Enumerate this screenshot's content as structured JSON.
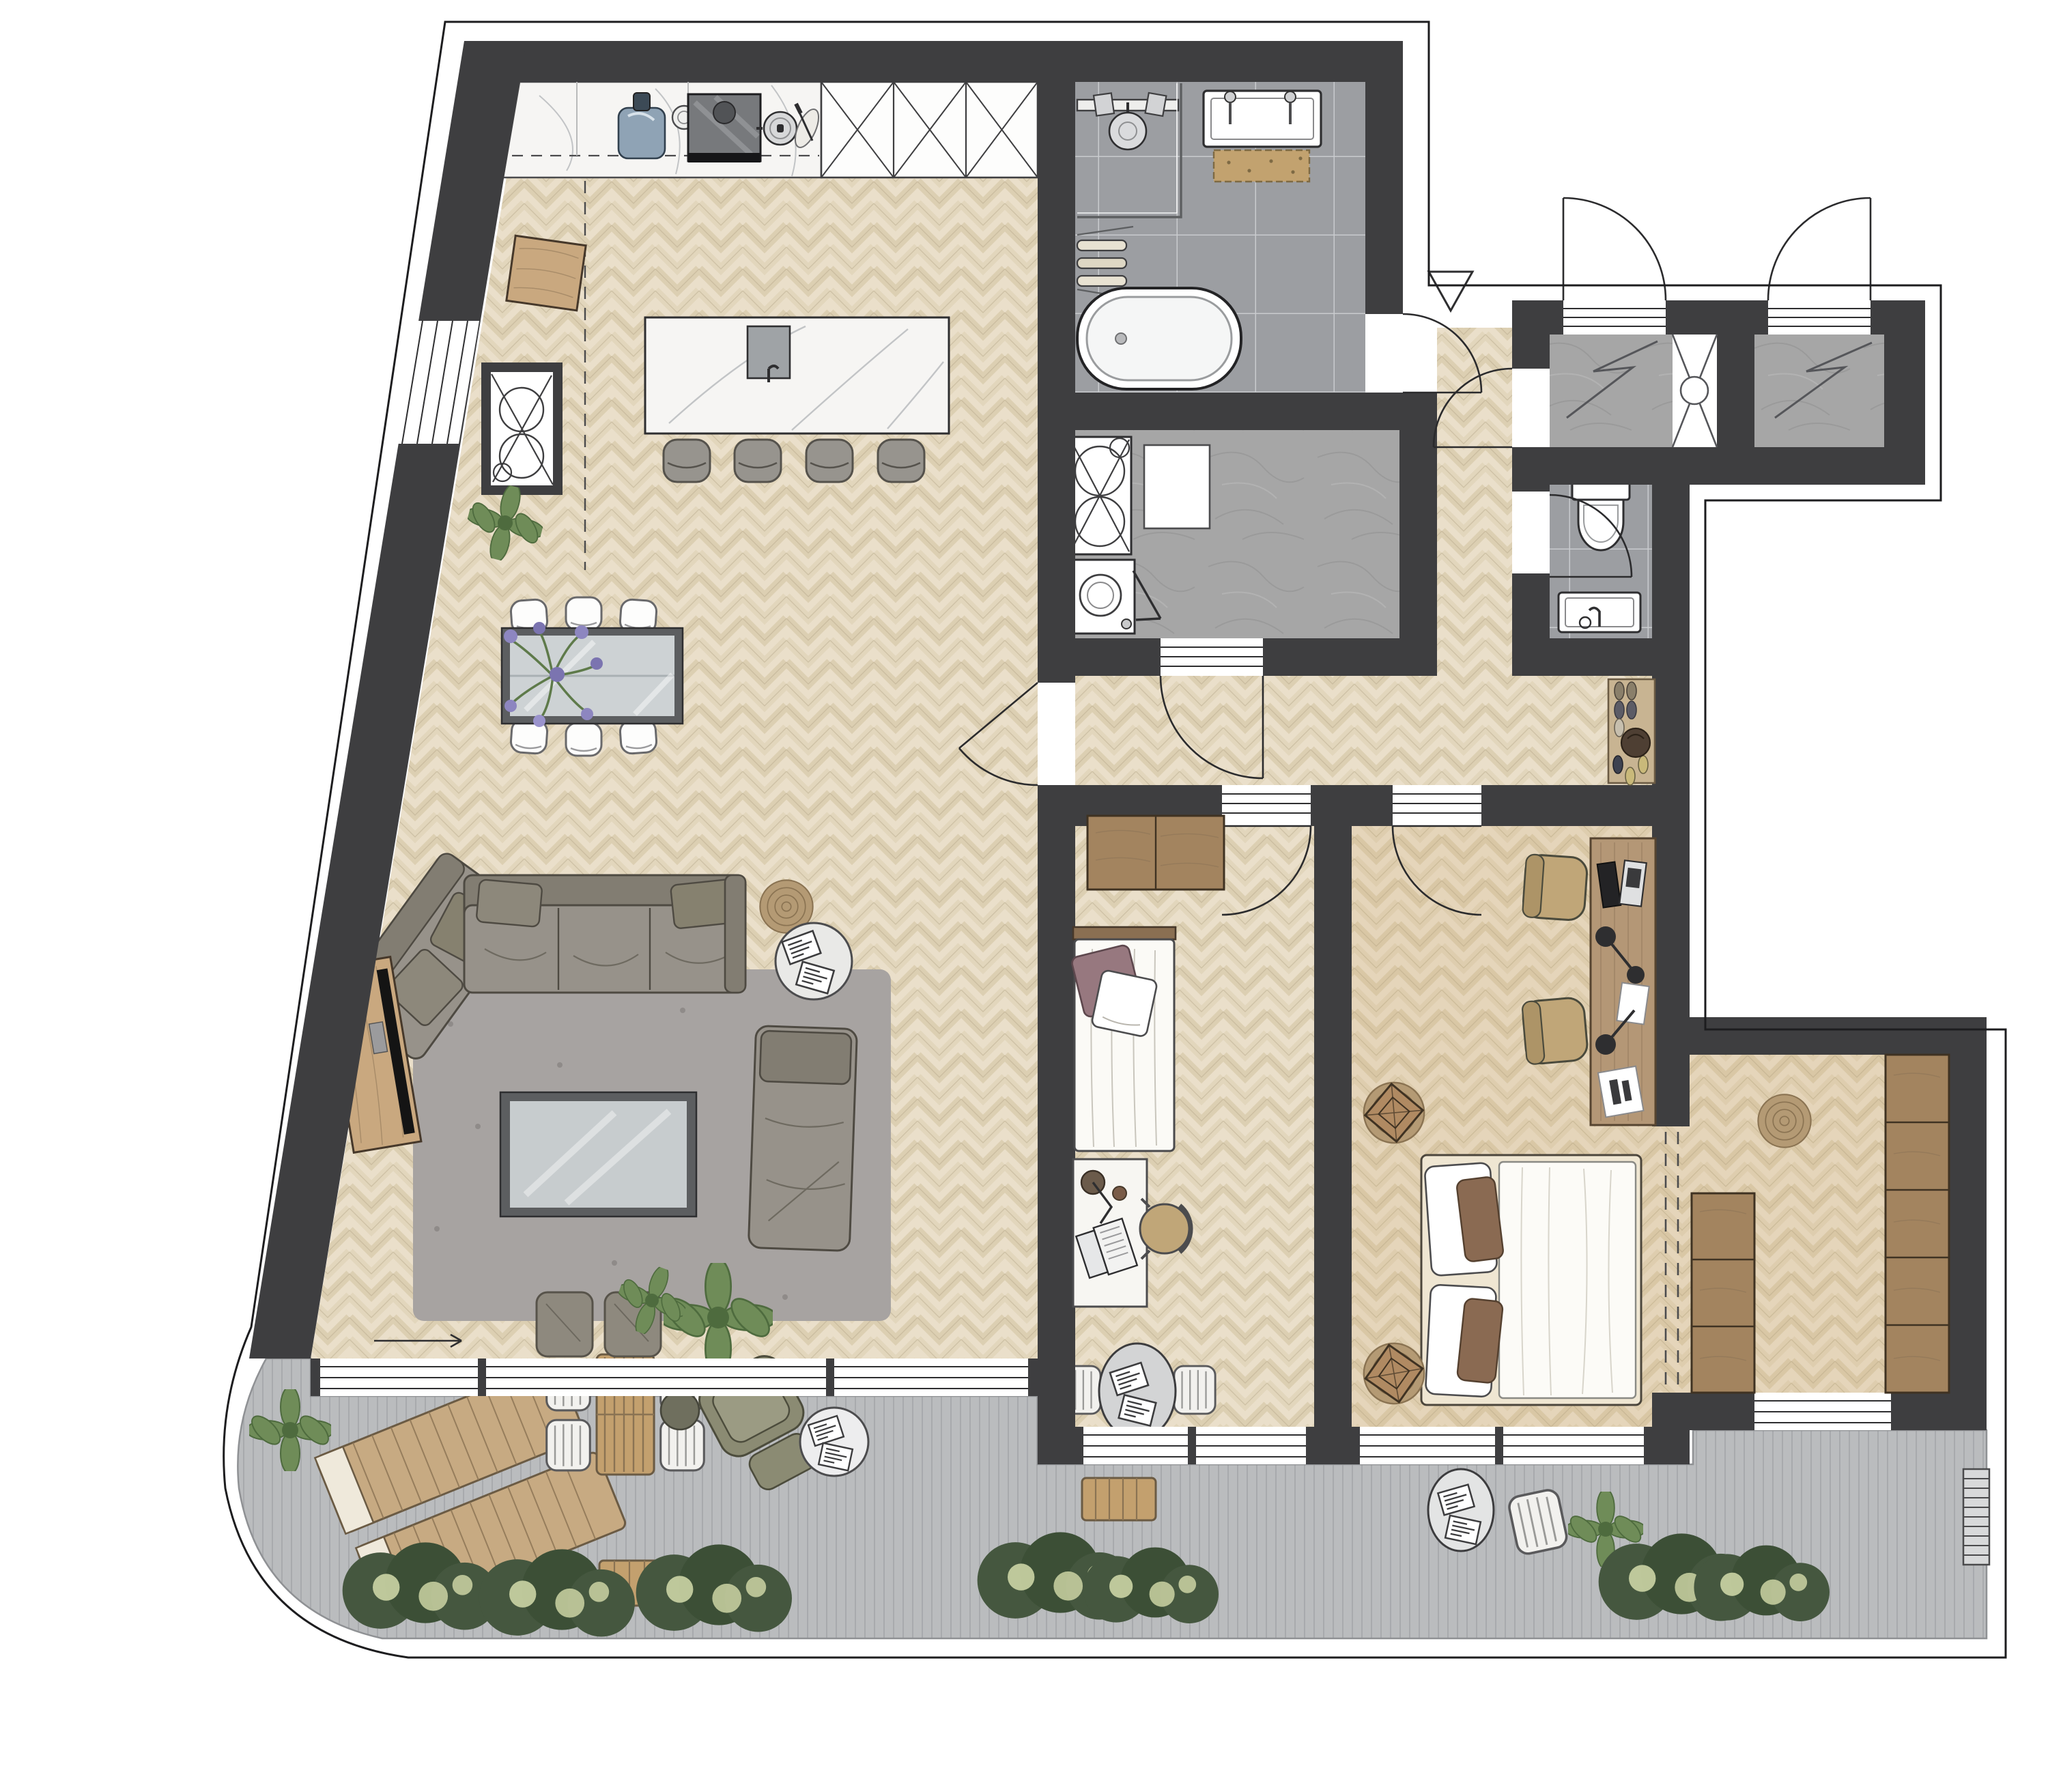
{
  "meta": {
    "title": "Apartment floor plan – rendered top view",
    "view": "top-down architectural plan",
    "visible_text": "none"
  },
  "colors": {
    "wall": "#3e3e40",
    "outline": "#1d1d1f",
    "floor-base": "#eadfca",
    "floor-plank": "#dccfb2",
    "floor-plank2": "#e2d6bc",
    "floor-line": "#b8a98c",
    "warm-overlay": "#c49a5f",
    "tile": "#9c9ea2",
    "grout": "#c9cbce",
    "concrete": "#a6a6a6",
    "deck": "#babcbe",
    "deck-line": "#a8aaad",
    "marble": "#f6f5f3",
    "vein": "#c2c4c6",
    "rug": "#a7a3a1",
    "sofa": "#97928a",
    "sofa-dark": "#827d72",
    "wood": "#c9a87f",
    "wardrobe": "#a3845f",
    "glass": "#cdd2d4",
    "frame": "#5c5e60",
    "plant": "#6f8c58",
    "plant-dark": "#4e6b3e",
    "hedge": "#45573f",
    "hedge-dot": "#d4dcab",
    "flower": "#8d86c0",
    "bathmat": "#c2a26f",
    "jute": "#b49a74",
    "mauve": "#97787f",
    "brown-pillow": "#8a6a52",
    "olive": "#8b8b73",
    "chair-tan": "#c0a678",
    "sink-blue": "#8fa3b5"
  },
  "rooms": [
    {
      "id": "kitchen-living-dining",
      "floor": "herringbone parquet",
      "features": [
        "kitchen counter",
        "tall cabinets x3",
        "kitchen island",
        "dining table",
        "living area"
      ]
    },
    {
      "id": "bathroom",
      "floor": "grey tile",
      "features": [
        "walk-in shower",
        "double vanity",
        "bath mat",
        "towel rail",
        "freestanding bathtub"
      ]
    },
    {
      "id": "laundry-room",
      "floor": "concrete",
      "features": [
        "stacked washer-dryer shaft symbol",
        "boiler",
        "washing machine with open door"
      ]
    },
    {
      "id": "wc",
      "floor": "grey tile",
      "features": [
        "wall-hung toilet",
        "hand basin"
      ]
    },
    {
      "id": "hallway",
      "floor": "herringbone parquet",
      "features": [
        "shoe rack with shoes and bag",
        "5 door swings"
      ]
    },
    {
      "id": "entry-vestibules",
      "floor": "concrete with doormat zigzag",
      "features": [
        "entry door swing x2",
        "installation shaft"
      ]
    },
    {
      "id": "bedroom-1",
      "floor": "herringbone parquet",
      "features": [
        "wardrobe",
        "single bed",
        "desk with laptop and lamp",
        "desk chair"
      ]
    },
    {
      "id": "bedroom-2",
      "floor": "herringbone parquet (warm)",
      "features": [
        "long desk",
        "monitor",
        "laptop",
        "2 desk lamps",
        "2 office chairs",
        "double bed",
        "2 round rugs with side tables"
      ]
    },
    {
      "id": "walk-in-closet",
      "floor": "herringbone parquet (warm)",
      "features": [
        "wardrobe column x3",
        "wardrobe column x5",
        "round jute rug",
        "window"
      ]
    },
    {
      "id": "terrace",
      "floor": "grey decking",
      "features": [
        "2 sun loungers",
        "4-chair coffee set",
        "2 wooden benches",
        "bistro set",
        "lounge chair",
        "2 side tables",
        "plants",
        "hedge x3"
      ]
    }
  ],
  "counts": {
    "dining_chairs": 6,
    "bar_stools": 4,
    "entry_doors": 2,
    "interior_door_swings": 7,
    "tall_kitchen_cabinets": 3,
    "left_wardrobe_units": 3,
    "right_wardrobe_units": 5,
    "poufs": 2,
    "sun_loungers": 2,
    "hedge_clusters": 3
  }
}
